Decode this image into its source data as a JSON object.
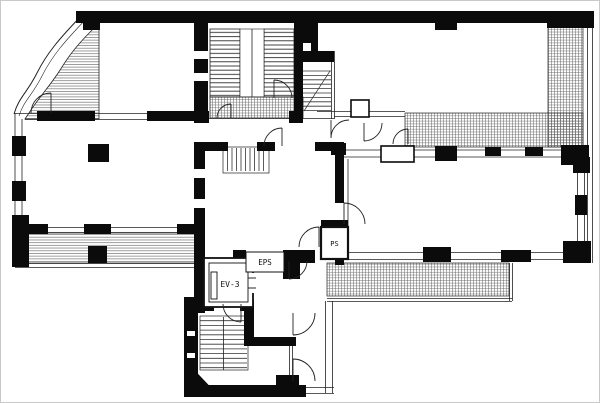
{
  "meta": {
    "type": "architectural-floor-plan",
    "description": "black and white building floor plan drawing"
  },
  "labels": {
    "elevator": "EV-3",
    "eps": "EPS",
    "ps": "PS"
  },
  "colors": {
    "wall": "#0b0b0b",
    "line": "#222222",
    "hatch_line": "#555555",
    "background": "#ffffff"
  }
}
